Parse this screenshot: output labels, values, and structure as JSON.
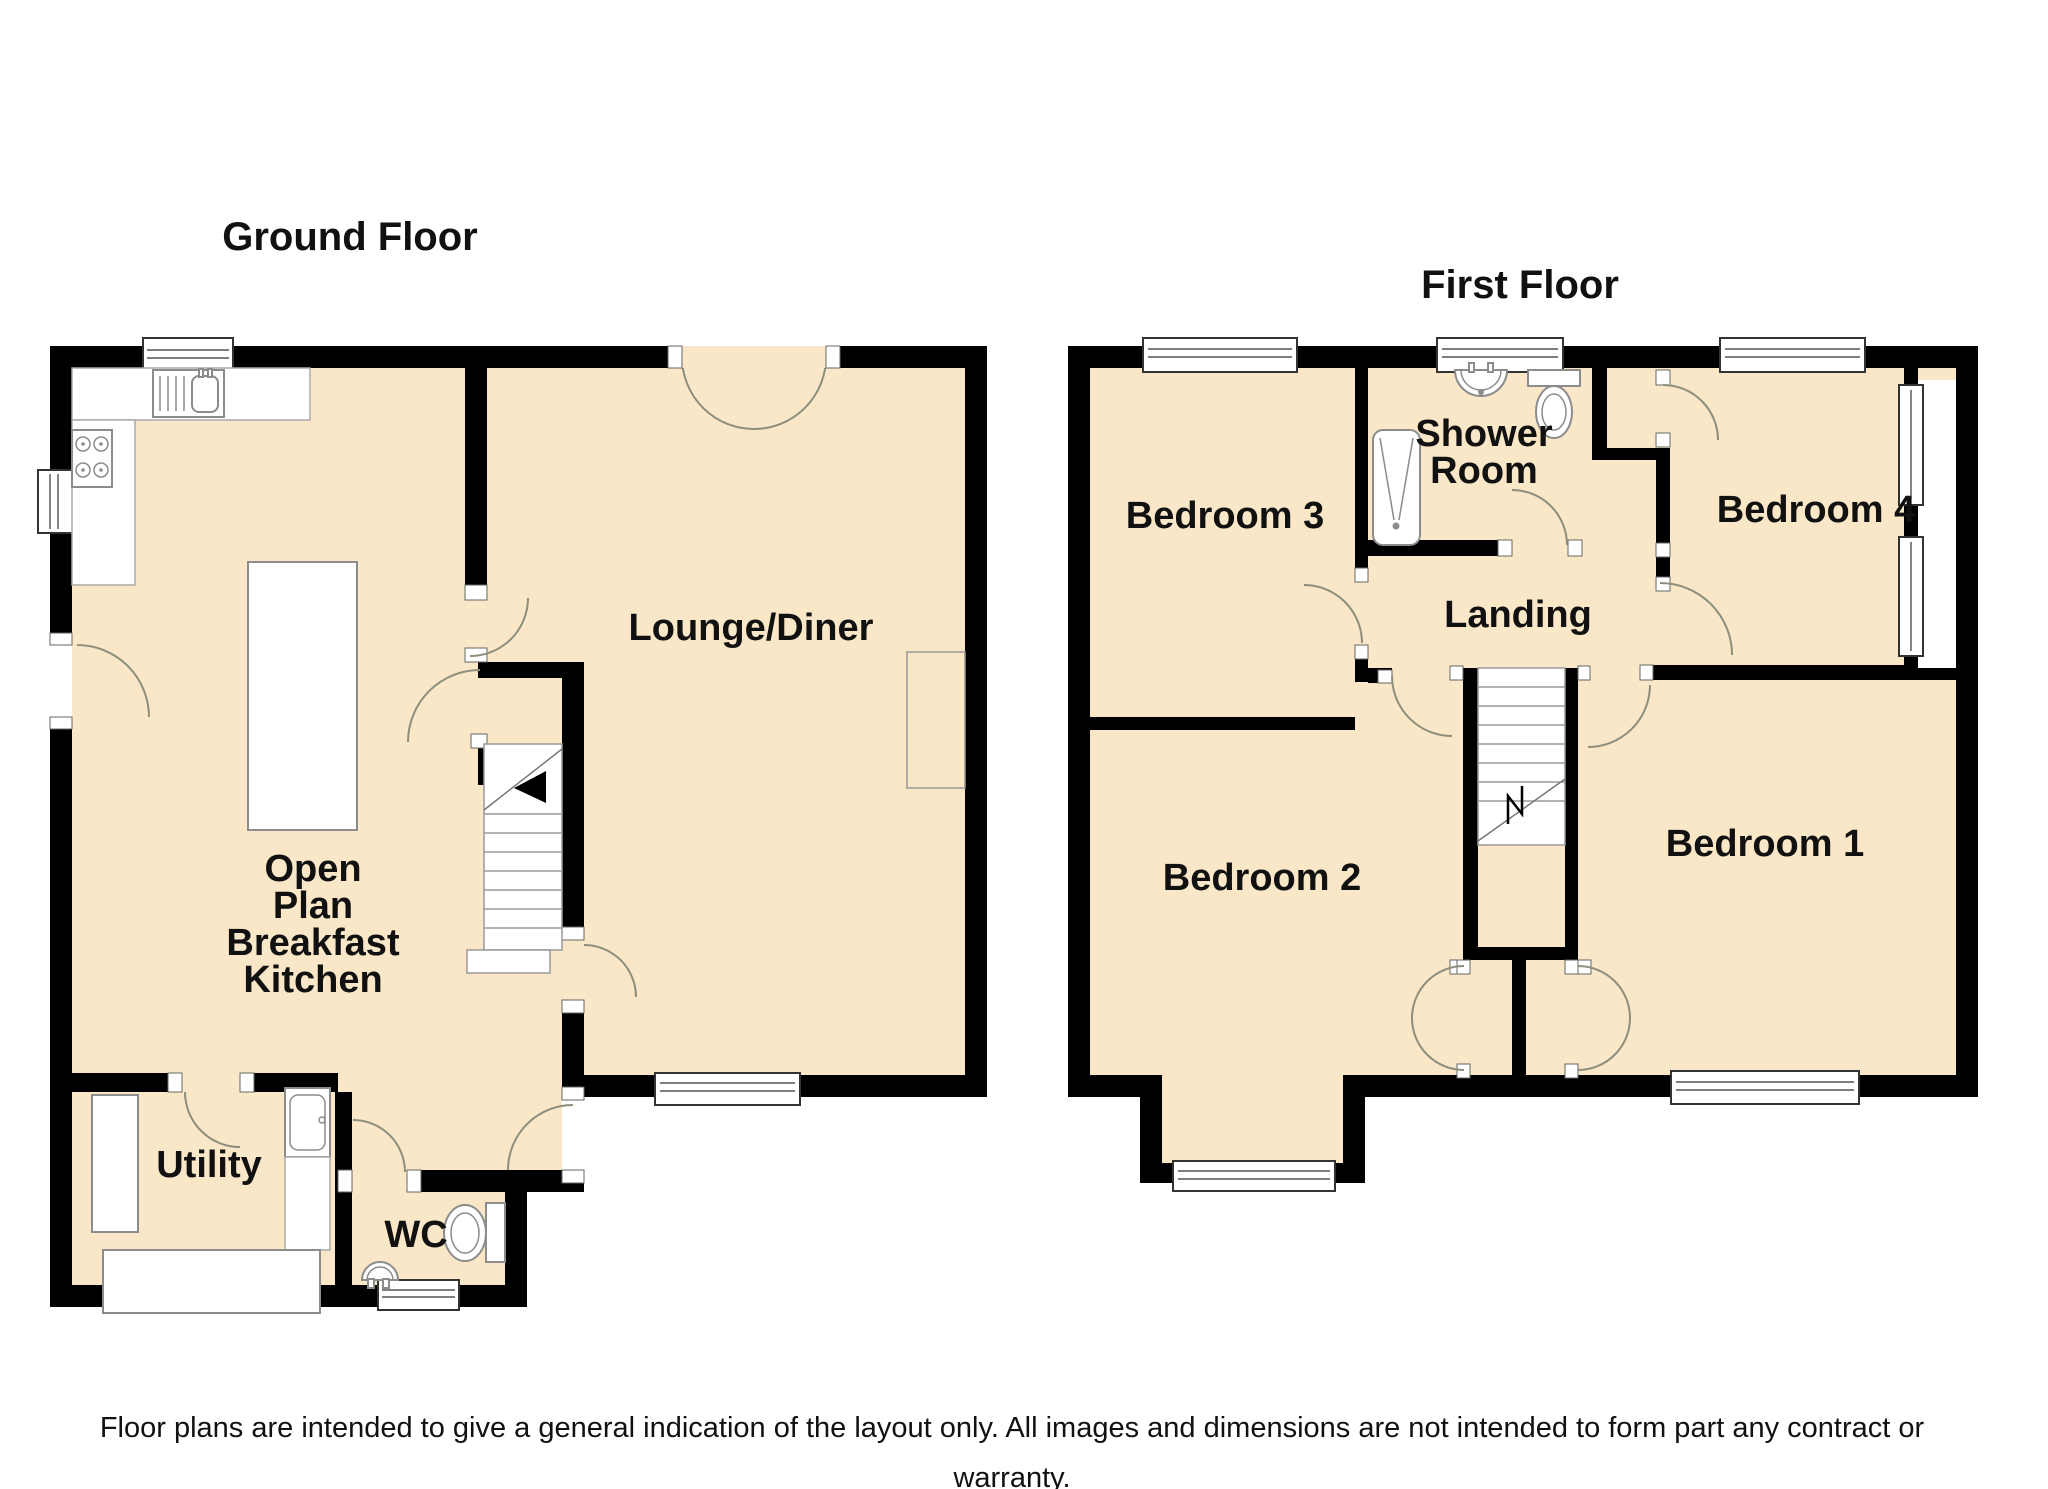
{
  "colors": {
    "floor": "#fae7c7",
    "wall": "#000000",
    "arc_stroke": "#8e8e7c",
    "fixture_stroke": "#8c8c8c",
    "text": "#111111",
    "background": "#ffffff"
  },
  "ground_floor": {
    "title": "Ground Floor",
    "labels": {
      "lounge": "Lounge/Diner",
      "kitchen": [
        "Open",
        "Plan",
        "Breakfast",
        "Kitchen"
      ],
      "utility": "Utility",
      "wc": "WC"
    }
  },
  "first_floor": {
    "title": "First Floor",
    "labels": {
      "bedroom1": "Bedroom 1",
      "bedroom2": "Bedroom 2",
      "bedroom3": "Bedroom 3",
      "bedroom4": "Bedroom 4",
      "shower": [
        "Shower",
        "Room"
      ],
      "landing": "Landing"
    }
  },
  "footer": {
    "line1": "Floor plans are intended to give a general indication of the layout only. All images and dimensions are not intended to form part any contract or",
    "line2": "warranty.",
    "line3": "Plan produced using PlanUp."
  }
}
